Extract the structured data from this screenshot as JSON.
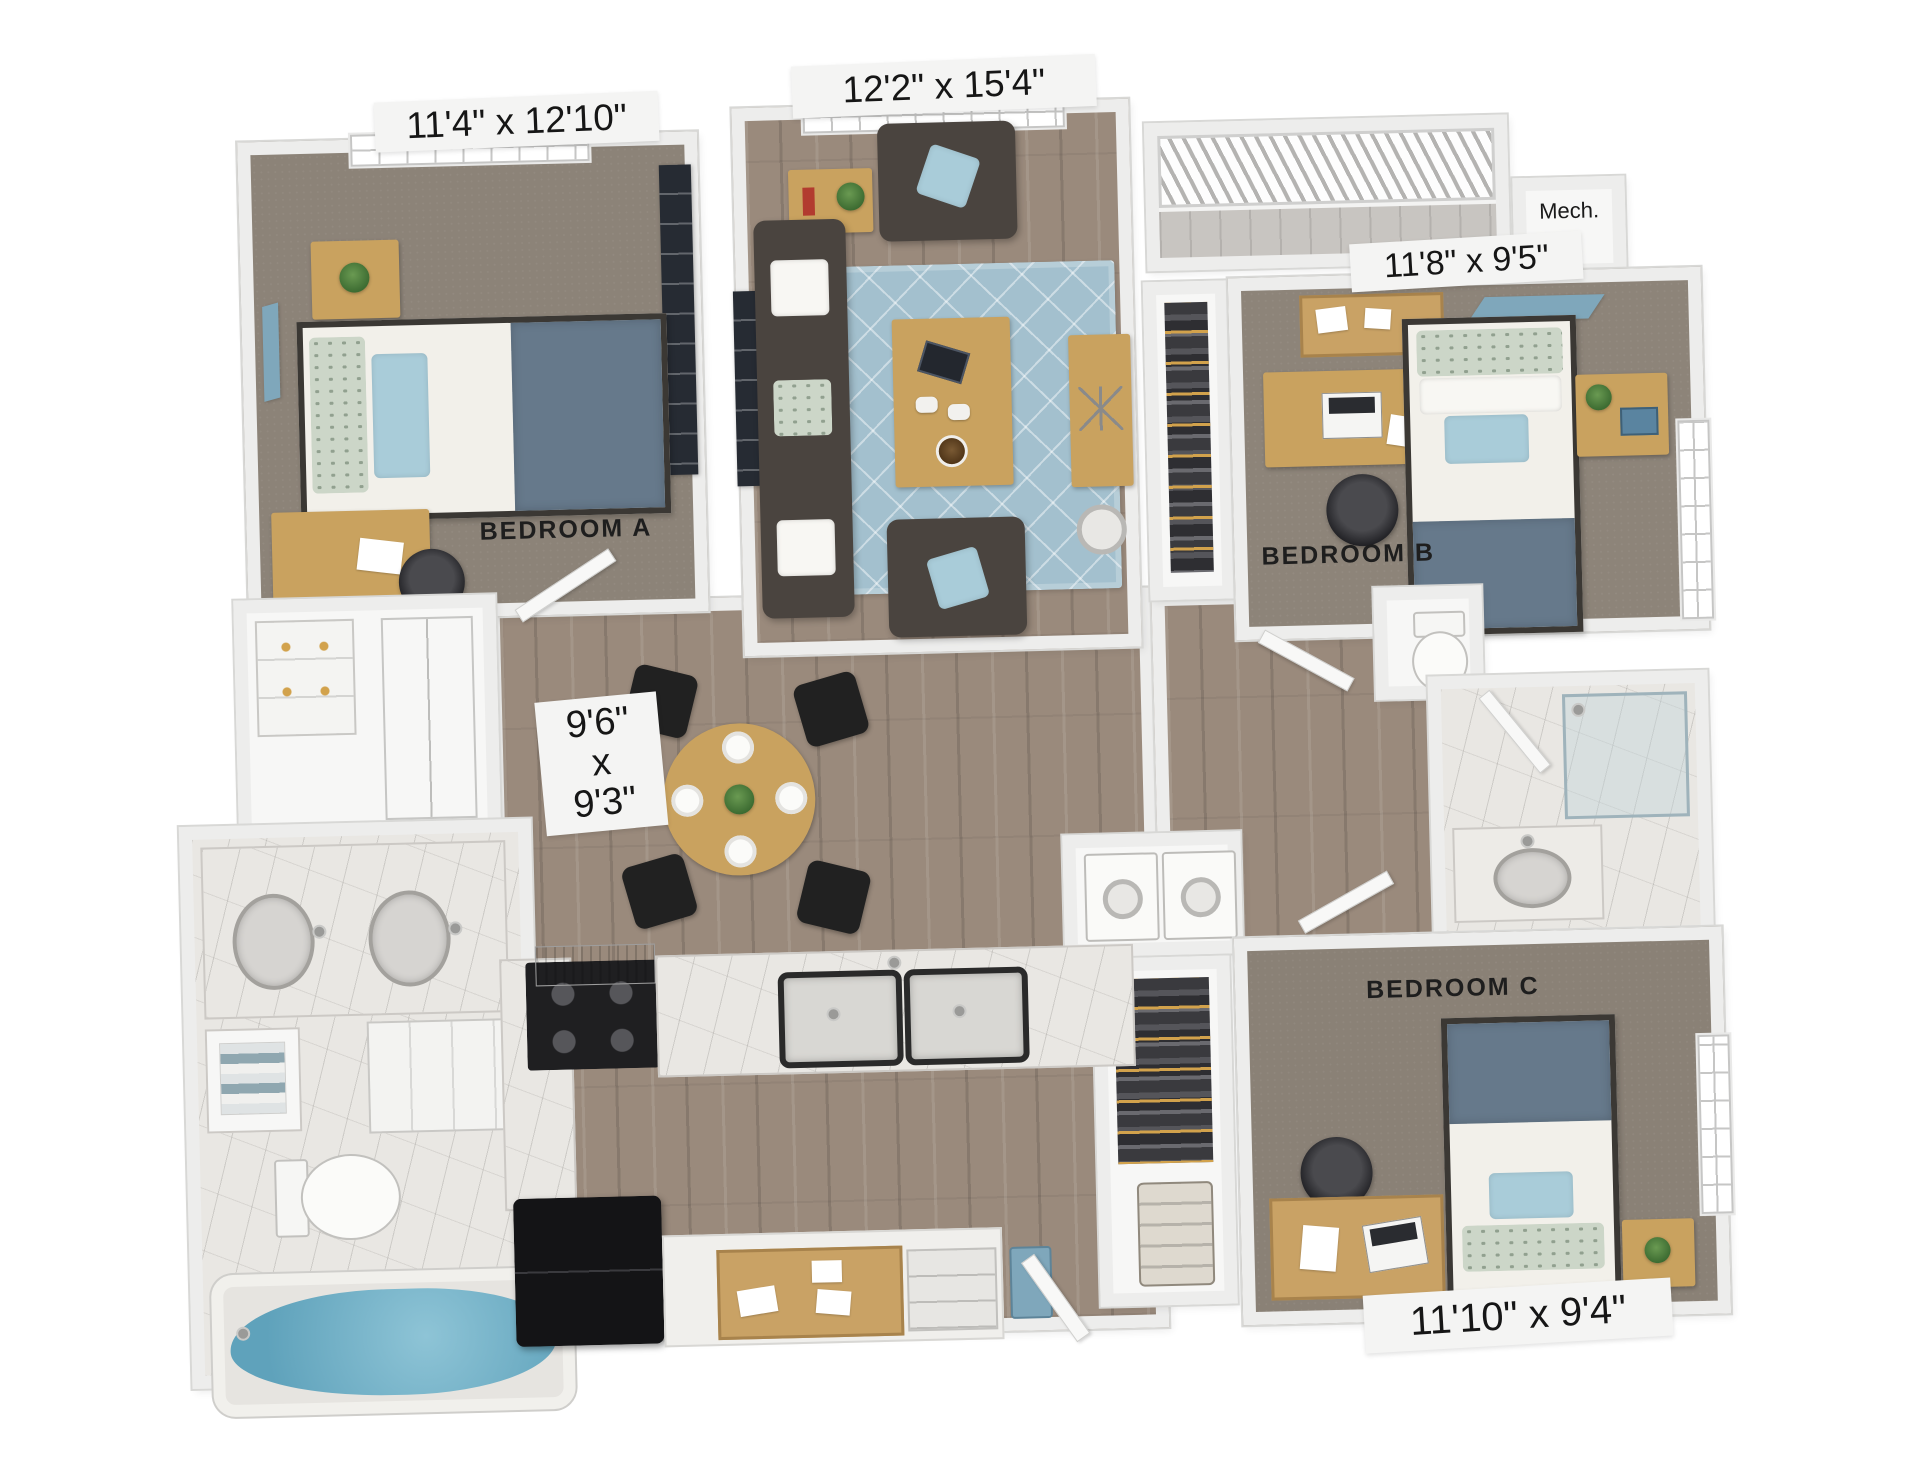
{
  "floorplan": {
    "type": "apartment-3d-floor-plan",
    "rooms": [
      {
        "id": "bedroom-a",
        "label": "BEDROOM A",
        "dimensions": "11'4\" x 12'10\""
      },
      {
        "id": "living-room",
        "dimensions": "12'2\" x 15'4\""
      },
      {
        "id": "bedroom-b",
        "label": "BEDROOM B",
        "dimensions": "11'8\" x 9'5\""
      },
      {
        "id": "bedroom-c",
        "label": "BEDROOM C",
        "dimensions": "11'10\" x 9'4\""
      },
      {
        "id": "dining",
        "dimensions_lines": [
          "9'6\"",
          "x",
          "9'3\""
        ]
      },
      {
        "id": "mechanical",
        "label": "Mech."
      }
    ],
    "colors": {
      "wall": "#ededec",
      "wood_floor": "#9a8a7c",
      "carpet": "#8c8378",
      "rug_blue": "#a3c0ce",
      "accent_blue_pillow": "#a9ccd9",
      "blanket_blue_gray": "#66798b",
      "furniture_wood": "#c9a25f",
      "dark_upholstery": "#4a443f",
      "tub_water": "#6fb0c7"
    }
  }
}
